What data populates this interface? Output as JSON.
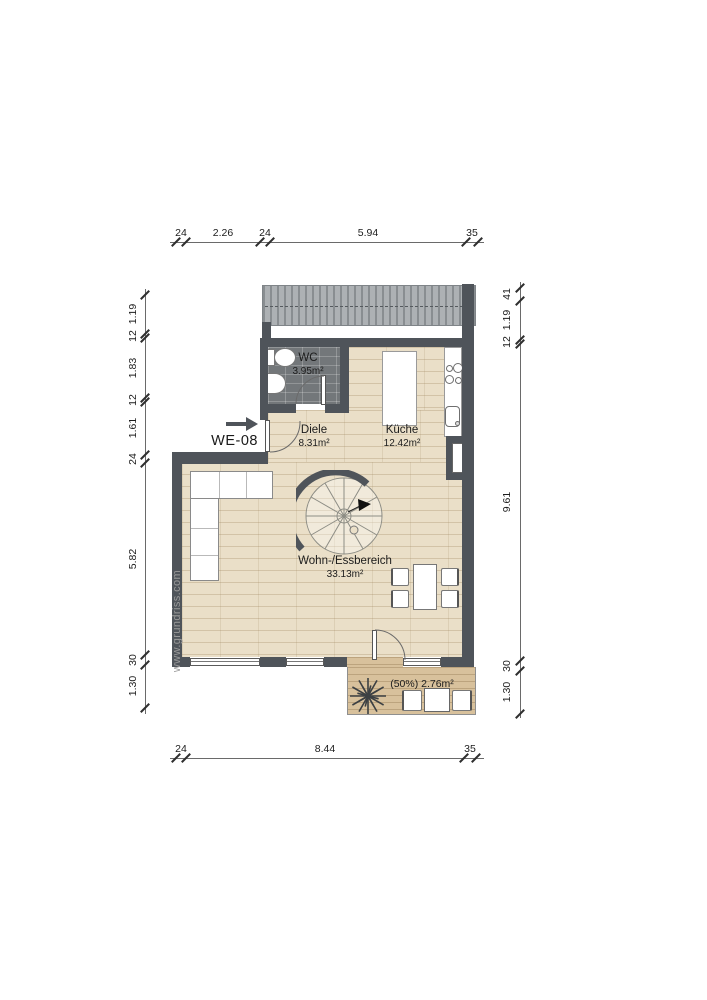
{
  "unit": {
    "label": "WE-08"
  },
  "watermark": "www.grundriss.com",
  "rooms": {
    "wc": {
      "name": "WC",
      "area": "3.95m²"
    },
    "diele": {
      "name": "Diele",
      "area": "8.31m²"
    },
    "kueche": {
      "name": "Küche",
      "area": "12.42m²"
    },
    "wohn_essbereich": {
      "name": "Wohn-/Essbereich",
      "area": "33.13m²"
    },
    "balkon": {
      "area": "(50%) 2.76m²"
    }
  },
  "dimensions": {
    "top": [
      "24",
      "2.26",
      "24",
      "5.94",
      "35"
    ],
    "bottom": [
      "24",
      "8.44",
      "35"
    ],
    "left": [
      "1.19",
      "12",
      "1.83",
      "12",
      "1.61",
      "24",
      "5.82",
      "30",
      "1.30"
    ],
    "right": [
      "41",
      "1.19",
      "12",
      "9.61",
      "30",
      "1.30"
    ]
  },
  "icons": {
    "entry_arrow": "right-arrow",
    "plant": "starburst-plant",
    "staircase": "spiral-stair"
  },
  "colors": {
    "wall": "#4f545a",
    "wood_floor": "#eadfc8",
    "tile_floor": "#73777a",
    "deck": "#d8c19c",
    "canopy": "#adb1b4"
  }
}
